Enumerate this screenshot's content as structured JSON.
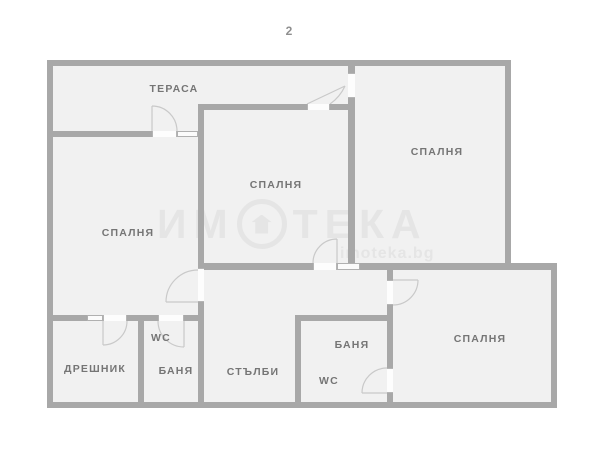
{
  "plan_number": "2",
  "colors": {
    "wall": "#a8a8a8",
    "fill": "#f1f1f1",
    "label": "#757575",
    "watermark": "#e5e5e5",
    "arc": "#c9c9c9"
  },
  "rooms": [
    {
      "id": "terrace",
      "label": "ТЕРАСА"
    },
    {
      "id": "bedroom-left",
      "label": "СПАЛНЯ"
    },
    {
      "id": "bedroom-middle",
      "label": "СПАЛНЯ"
    },
    {
      "id": "bedroom-top-right",
      "label": "СПАЛНЯ"
    },
    {
      "id": "bedroom-bottom-right",
      "label": "СПАЛНЯ"
    },
    {
      "id": "closet",
      "label": "ДРЕШНИК"
    },
    {
      "id": "wc-left",
      "label": "WC"
    },
    {
      "id": "bath-left",
      "label": "БАНЯ"
    },
    {
      "id": "stairs",
      "label": "СТЪЛБИ"
    },
    {
      "id": "bath-right",
      "label": "БАНЯ"
    },
    {
      "id": "wc-right",
      "label": "WC"
    }
  ],
  "watermark": {
    "brand_prefix": "ИМ",
    "brand_suffix": "ТЕКА",
    "website": "imoteka.bg"
  }
}
